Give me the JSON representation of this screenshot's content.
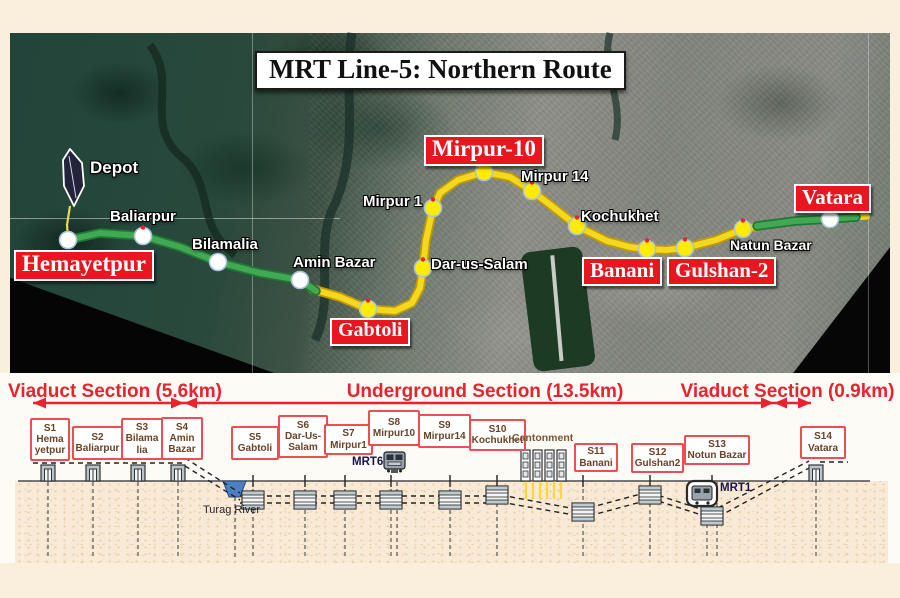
{
  "title": "MRT Line-5: Northern Route",
  "map": {
    "depot": "Depot",
    "major_stations": [
      "Hemayetpur",
      "Gabtoli",
      "Mirpur-10",
      "Banani",
      "Gulshan-2",
      "Vatara"
    ],
    "minor_stations": [
      "Baliarpur",
      "Bilamalia",
      "Amin Bazar",
      "Mirpur 1",
      "Dar-us-Salam",
      "Mirpur 14",
      "Kochukhet",
      "Natun Bazar"
    ]
  },
  "sections": [
    {
      "label": "Viaduct Section (5.6km)"
    },
    {
      "label": "Underground Section (13.5km)"
    },
    {
      "label": "Viaduct Section (0.9km)"
    }
  ],
  "schematic": {
    "boxes": [
      {
        "lines": [
          "S1",
          "Hema",
          "yetpur"
        ]
      },
      {
        "lines": [
          "S2",
          "Baliarpur"
        ]
      },
      {
        "lines": [
          "S3",
          "Bilama",
          "lia"
        ]
      },
      {
        "lines": [
          "S4",
          "Amin",
          "Bazar"
        ]
      },
      {
        "lines": [
          "S5",
          "Gabtoli"
        ]
      },
      {
        "lines": [
          "S6",
          "Dar-Us-",
          "Salam"
        ]
      },
      {
        "lines": [
          "S7",
          "Mirpur1"
        ]
      },
      {
        "lines": [
          "S8",
          "Mirpur10"
        ]
      },
      {
        "lines": [
          "S9",
          "Mirpur14"
        ]
      },
      {
        "lines": [
          "S10",
          "Kochukhet"
        ]
      },
      {
        "lines": [
          "S11",
          "Banani"
        ]
      },
      {
        "lines": [
          "S12",
          "Gulshan2"
        ]
      },
      {
        "lines": [
          "S13",
          "Notun Bazar"
        ]
      },
      {
        "lines": [
          "S14",
          "Vatara"
        ]
      }
    ],
    "cantonment_label": "Cantonment",
    "river_label": "Turag River",
    "mrt6_label": "MRT6",
    "mrt1_label": "MRT1"
  },
  "colors": {
    "viaduct_route": "#3fa34d",
    "underground_route": "#f2d41e",
    "section_red": "#e8232e",
    "station_box_border": "#ef4d52",
    "station_box_text": "#6b4226",
    "map_red_label_bg": "#e7161f"
  }
}
